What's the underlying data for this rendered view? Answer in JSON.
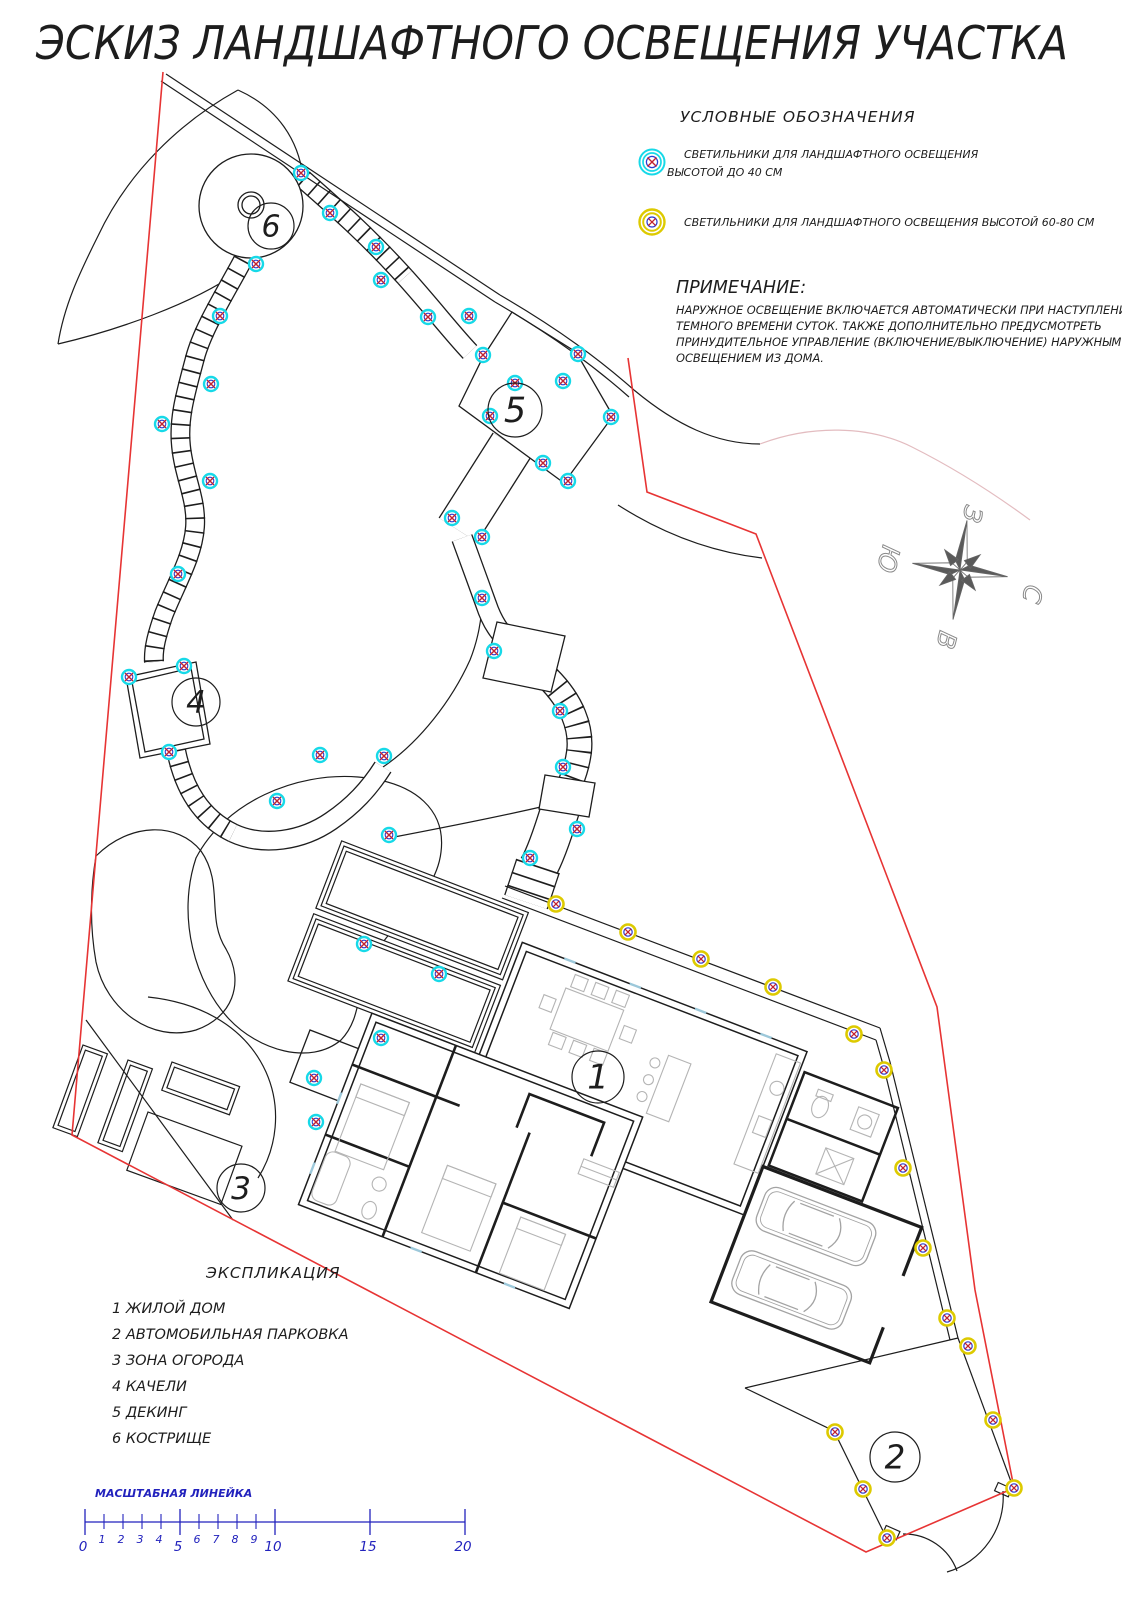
{
  "title": "ЭСКИЗ ЛАНДШАФТНОГО ОСВЕЩЕНИЯ УЧАСТКА",
  "legend": {
    "heading": "УСЛОВНЫЕ ОБОЗНАЧЕНИЯ",
    "items": [
      {
        "symbol": "lamp-low-icon",
        "ring_color": "#16d9e8",
        "line1": "СВЕТИЛЬНИКИ ДЛЯ ЛАНДШАФТНОГО  ОСВЕЩЕНИЯ",
        "line2": "ВЫСОТОЙ ДО 40 СМ"
      },
      {
        "symbol": "lamp-high-icon",
        "ring_color": "#ddca00",
        "line1": "СВЕТИЛЬНИКИ ДЛЯ ЛАНДШАФТНОГО  ОСВЕЩЕНИЯ ВЫСОТОЙ 60-80 СМ",
        "line2": ""
      }
    ]
  },
  "note": {
    "heading": "ПРИМЕЧАНИЕ:",
    "lines": [
      "НАРУЖНОЕ ОСВЕЩЕНИЕ ВКЛЮЧАЕТСЯ АВТОМАТИЧЕСКИ ПРИ НАСТУПЛЕНИИ",
      "ТЕМНОГО ВРЕМЕНИ СУТОК. ТАКЖЕ ДОПОЛНИТЕЛЬНО ПРЕДУСМОТРЕТЬ",
      "ПРИНУДИТЕЛЬНОЕ УПРАВЛЕНИЕ (ВКЛЮЧЕНИЕ/ВЫКЛЮЧЕНИЕ) НАРУЖНЫМ",
      "ОСВЕЩЕНИЕМ ИЗ ДОМА."
    ]
  },
  "compass": {
    "north": "С",
    "south": "Ю",
    "west": "З",
    "east": "В"
  },
  "explication": {
    "heading": "ЭКСПЛИКАЦИЯ",
    "items": [
      {
        "num": "1",
        "label": "ЖИЛОЙ ДОМ"
      },
      {
        "num": "2",
        "label": "АВТОМОБИЛЬНАЯ ПАРКОВКА"
      },
      {
        "num": "3",
        "label": "ЗОНА ОГОРОДА"
      },
      {
        "num": "4",
        "label": "КАЧЕЛИ"
      },
      {
        "num": "5",
        "label": "ДЕКИНГ"
      },
      {
        "num": "6",
        "label": "КОСТРИЩЕ"
      }
    ]
  },
  "features": [
    {
      "num": "1",
      "x": 598,
      "y": 1077,
      "r": 26
    },
    {
      "num": "2",
      "x": 895,
      "y": 1457,
      "r": 25
    },
    {
      "num": "3",
      "x": 241,
      "y": 1188,
      "r": 24
    },
    {
      "num": "4",
      "x": 196,
      "y": 702,
      "r": 24
    },
    {
      "num": "5",
      "x": 515,
      "y": 410,
      "r": 27
    },
    {
      "num": "6",
      "x": 271,
      "y": 226,
      "r": 23
    }
  ],
  "lamps": {
    "low": {
      "name": "lamp-low-icon",
      "points": [
        [
          301,
          173
        ],
        [
          330,
          213
        ],
        [
          376,
          247
        ],
        [
          381,
          280
        ],
        [
          428,
          317
        ],
        [
          469,
          316
        ],
        [
          483,
          355
        ],
        [
          578,
          354
        ],
        [
          515,
          383
        ],
        [
          563,
          381
        ],
        [
          490,
          416
        ],
        [
          611,
          417
        ],
        [
          543,
          463
        ],
        [
          568,
          481
        ],
        [
          452,
          518
        ],
        [
          482,
          537
        ],
        [
          482,
          598
        ],
        [
          494,
          651
        ],
        [
          560,
          711
        ],
        [
          563,
          767
        ],
        [
          577,
          829
        ],
        [
          530,
          858
        ],
        [
          256,
          264
        ],
        [
          220,
          316
        ],
        [
          211,
          384
        ],
        [
          162,
          424
        ],
        [
          210,
          481
        ],
        [
          178,
          574
        ],
        [
          184,
          666
        ],
        [
          129,
          677
        ],
        [
          169,
          752
        ],
        [
          277,
          801
        ],
        [
          320,
          755
        ],
        [
          384,
          756
        ],
        [
          389,
          835
        ],
        [
          364,
          944
        ],
        [
          439,
          974
        ],
        [
          381,
          1038
        ],
        [
          314,
          1078
        ],
        [
          316,
          1122
        ]
      ]
    },
    "high": {
      "name": "lamp-high-icon",
      "points": [
        [
          556,
          904
        ],
        [
          628,
          932
        ],
        [
          701,
          959
        ],
        [
          773,
          987
        ],
        [
          854,
          1034
        ],
        [
          884,
          1070
        ],
        [
          903,
          1168
        ],
        [
          923,
          1248
        ],
        [
          947,
          1318
        ],
        [
          968,
          1346
        ],
        [
          993,
          1420
        ],
        [
          1014,
          1488
        ],
        [
          887,
          1538
        ],
        [
          863,
          1489
        ],
        [
          835,
          1432
        ]
      ]
    }
  },
  "ruler": {
    "heading": "МАСШТАБНАЯ ЛИНЕЙКА",
    "major": [
      {
        "v": "0",
        "x": 85
      },
      {
        "v": "5",
        "x": 180
      },
      {
        "v": "10",
        "x": 275
      },
      {
        "v": "15",
        "x": 370
      },
      {
        "v": "20",
        "x": 465
      }
    ],
    "minor": [
      {
        "v": "1",
        "x": 104
      },
      {
        "v": "2",
        "x": 123
      },
      {
        "v": "3",
        "x": 142
      },
      {
        "v": "4",
        "x": 161
      },
      {
        "v": "6",
        "x": 199
      },
      {
        "v": "7",
        "x": 218
      },
      {
        "v": "8",
        "x": 237
      },
      {
        "v": "9",
        "x": 256
      }
    ]
  },
  "colors": {
    "line": "#1d1d1d",
    "red": "#e73434",
    "blue": "#2222bd",
    "lamp_low_ring": "#16d9e8",
    "lamp_high_ring": "#ddca00",
    "lamp_inner": "#2b3bd0",
    "lamp_cross": "#c22230",
    "furniture": "#b4b4b4",
    "car": "#a3a3a3",
    "pink": "#e3bcc0",
    "window": "#9cc8da"
  }
}
